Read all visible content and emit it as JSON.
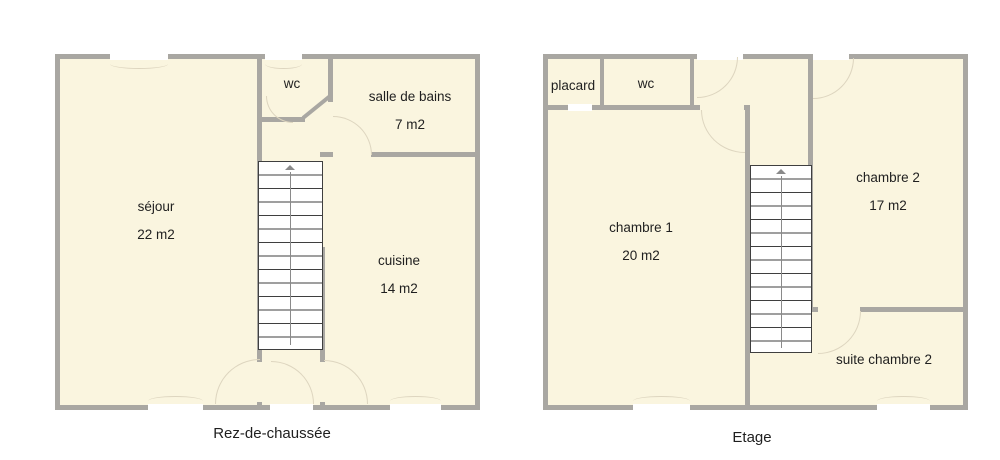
{
  "colors": {
    "room_fill": "#faf5df",
    "wall": "#a9a7a2",
    "stair_line": "#3f3f3f",
    "stair_rail": "#8a8a8a",
    "arc_line": "#ddd5bf",
    "window_fill": "#ffffff",
    "text": "#1f1f1f"
  },
  "floors": [
    {
      "caption": "Rez-de-chaussée",
      "rooms": [
        {
          "name": "séjour",
          "area": "22 m2"
        },
        {
          "name": "wc",
          "area": ""
        },
        {
          "name": "salle de bains",
          "area": "7 m2"
        },
        {
          "name": "cuisine",
          "area": "14 m2"
        }
      ]
    },
    {
      "caption": "Etage",
      "rooms": [
        {
          "name": "placard",
          "area": ""
        },
        {
          "name": "wc",
          "area": ""
        },
        {
          "name": "chambre 1",
          "area": "20 m2"
        },
        {
          "name": "chambre 2",
          "area": "17 m2"
        },
        {
          "name": "suite chambre 2",
          "area": ""
        }
      ]
    }
  ]
}
